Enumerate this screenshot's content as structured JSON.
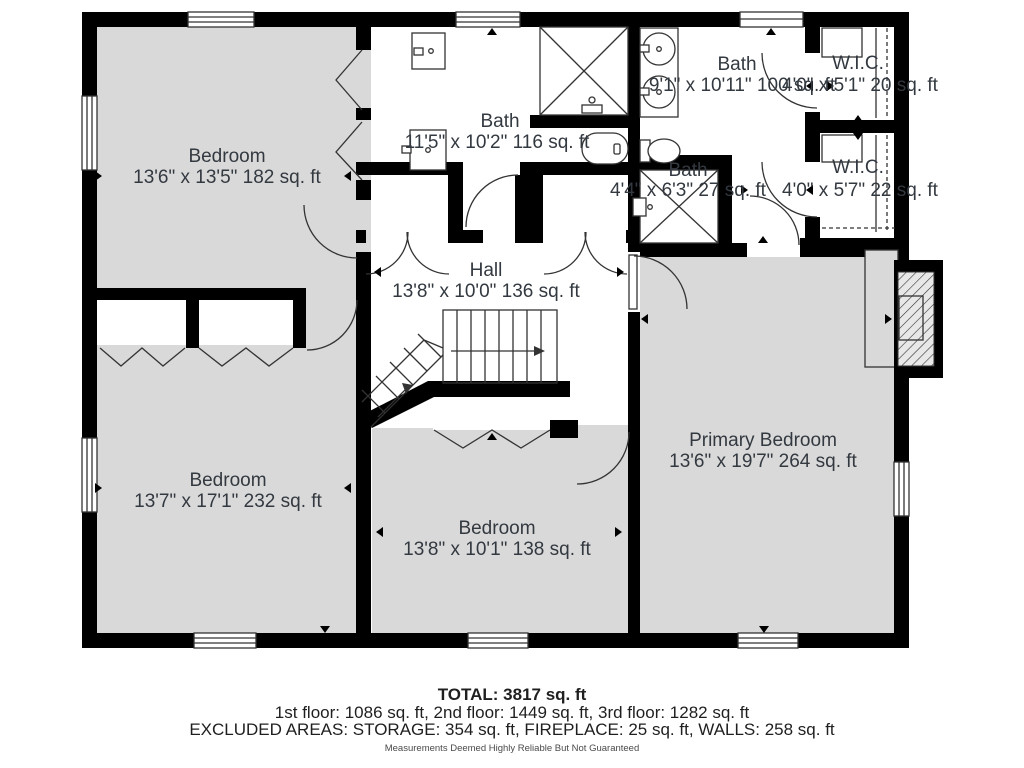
{
  "plan": {
    "rooms": {
      "bedroom_tl": {
        "name": "Bedroom",
        "dims": "13'6\" x 13'5\" 182 sq. ft"
      },
      "bath_center": {
        "name": "Bath",
        "dims": "11'5\" x 10'2\" 116 sq. ft"
      },
      "bath_right": {
        "name": "Bath",
        "dims": "9'1\" x 10'11\" 100 sq. ft"
      },
      "wic_top": {
        "name": "W.I.C.",
        "dims": "4'0\" x 5'1\" 20 sq. ft"
      },
      "bath_small": {
        "name": "Bath",
        "dims": "4'4\" x 6'3\" 27 sq. ft"
      },
      "wic_bottom": {
        "name": "W.I.C.",
        "dims": "4'0\" x 5'7\" 22 sq. ft"
      },
      "hall": {
        "name": "Hall",
        "dims": "13'8\" x 10'0\" 136 sq. ft"
      },
      "bedroom_bl": {
        "name": "Bedroom",
        "dims": "13'7\" x 17'1\" 232 sq. ft"
      },
      "bedroom_bm": {
        "name": "Bedroom",
        "dims": "13'8\" x 10'1\" 138 sq. ft"
      },
      "primary": {
        "name": "Primary Bedroom",
        "dims": "13'6\" x 19'7\" 264 sq. ft"
      }
    },
    "summary": {
      "total": "TOTAL: 3817 sq. ft",
      "floors": "1st floor: 1086 sq. ft, 2nd floor: 1449 sq. ft, 3rd floor: 1282 sq. ft",
      "excluded": "EXCLUDED AREAS: STORAGE: 354 sq. ft, FIREPLACE: 25 sq. ft, WALLS: 258 sq. ft",
      "disclaimer": "Measurements Deemed Highly Reliable But Not Guaranteed"
    },
    "colors": {
      "wall": "#000000",
      "room_fill": "#d9d9d9",
      "floor_white": "#ffffff",
      "text": "#333940"
    }
  }
}
